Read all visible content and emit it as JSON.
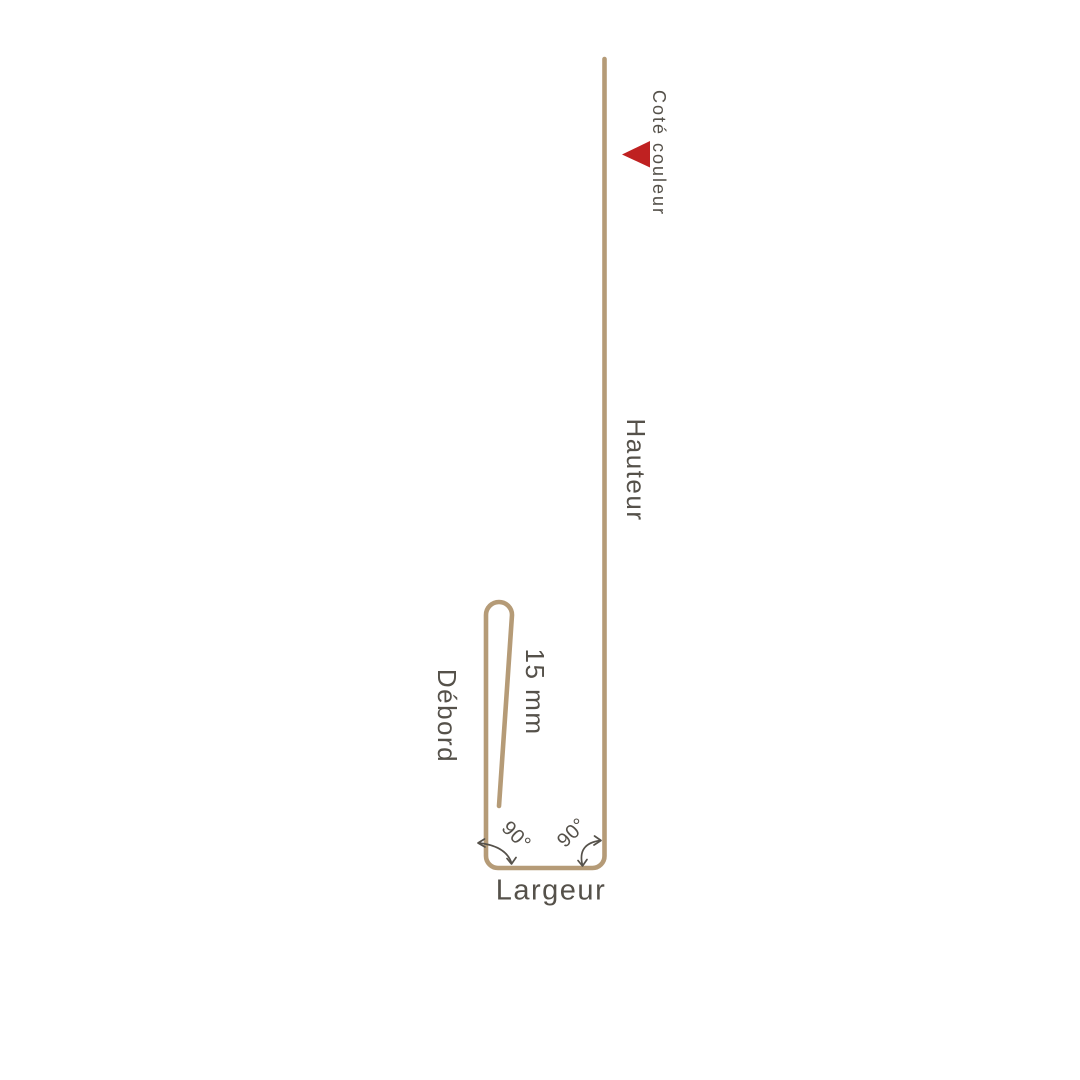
{
  "colors": {
    "background": "#ffffff",
    "profile_line": "#b59b77",
    "label_text": "#55514a",
    "angle_arrow": "#55514a",
    "marker_red": "#bf2121"
  },
  "diagram": {
    "labels": {
      "color_side": "Coté couleur",
      "height": "Hauteur",
      "hem": "15 mm",
      "overhang": "Débord",
      "angle_left": "90°",
      "angle_right": "90°",
      "width": "Largeur"
    }
  }
}
